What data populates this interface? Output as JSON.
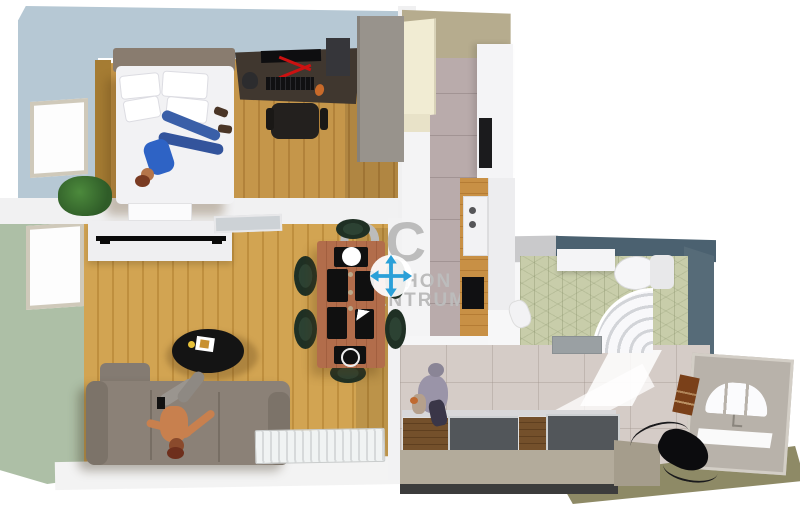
{
  "view": {
    "description": "3D top-down floor plan render of a small apartment",
    "canvas_width": 800,
    "canvas_height": 511,
    "background": "#ffffff"
  },
  "watermark": {
    "logo": "OC",
    "line1": "OTTHON",
    "line2": "CENTRUM",
    "text_color": "#bcbcbc",
    "move_icon": "four-way-move-arrows",
    "move_icon_color": "#2aa0d8",
    "move_icon_circle": "#ffffff"
  },
  "rooms": {
    "bedroom": {
      "name": "bedroom",
      "wall_color": "#b6c8d4",
      "floor_color": "#c5964a",
      "items": [
        "double bed with white bedding and pillows",
        "person lying on bed",
        "dark desk with monitor, red stand, keyboard, headphones, PC tower",
        "office chair",
        "grey wardrobe",
        "window",
        "potted plant"
      ]
    },
    "living_room": {
      "name": "living room",
      "wall_color": "#adbfa6",
      "floor_color": "#d2a452",
      "items": [
        "white TV cabinet with flat TV",
        "wooden dining table",
        "six dark-green chairs",
        "black placemats with plates",
        "black oval coffee table with magazine",
        "grey sofa with person sitting",
        "white radiator",
        "window",
        "open glass door"
      ]
    },
    "kitchen": {
      "name": "kitchen",
      "wall_color": "#b6ac8e",
      "floor_color": "#b9abab",
      "items": [
        "cream cabinets",
        "tall white fridge unit",
        "black oven",
        "wooden counter",
        "sink",
        "black cooktop"
      ]
    },
    "bathroom": {
      "name": "bathroom",
      "wall_color": "#4b6170",
      "floor_color": "#c8cdaa",
      "items": [
        "white vanity",
        "toilet with tank",
        "curved corner shower",
        "washer",
        "hexagonal green tile floor"
      ]
    },
    "hallway": {
      "name": "entrance hall",
      "wall_color": "#8e8a66",
      "floor_color": "#d5ccc7",
      "items": [
        "front door with arched glazing",
        "sliding-door wardrobe (wood and grey panels)",
        "person crouching",
        "black pile of clothes with cables",
        "brown wall hanging"
      ]
    }
  }
}
